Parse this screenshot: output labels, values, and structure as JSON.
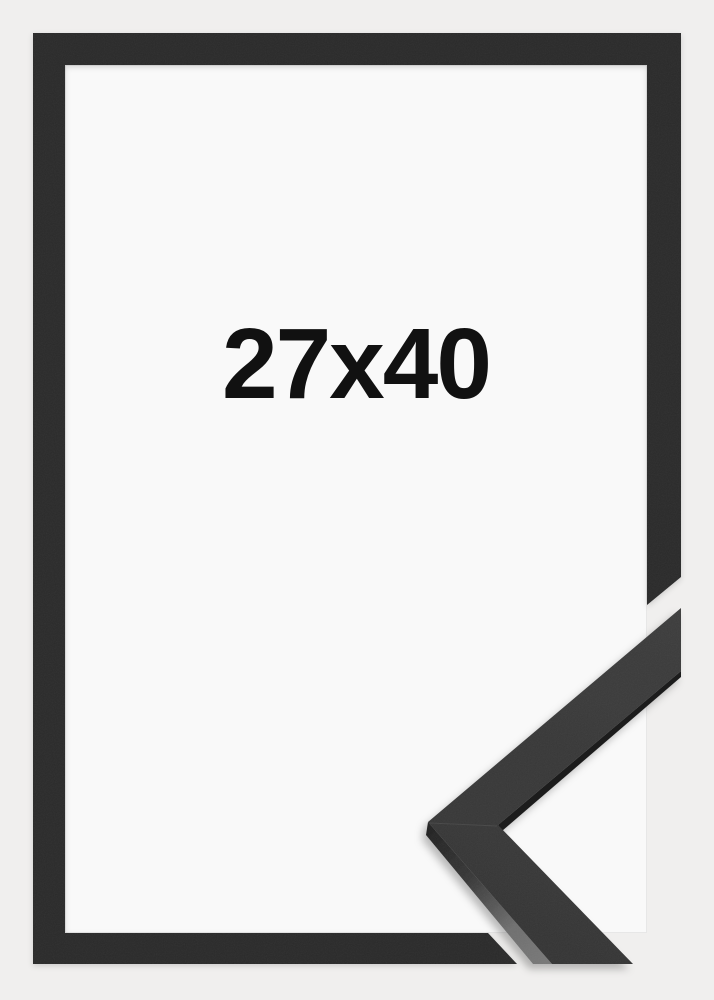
{
  "product": {
    "size_label": "27x40"
  },
  "graphic": {
    "frame_style": "thin black picture frame",
    "detail": "mitered moulding corner sample overlapping the bottom-right corner"
  },
  "colors": {
    "background": "#f0efee",
    "opening_background": "#f9f9f9",
    "frame": "#2b2b2b",
    "sample_face": "#353535",
    "sample_side_light": "#6f6f6f",
    "sample_side_dark": "#1f1f1f",
    "label": "#111111"
  }
}
